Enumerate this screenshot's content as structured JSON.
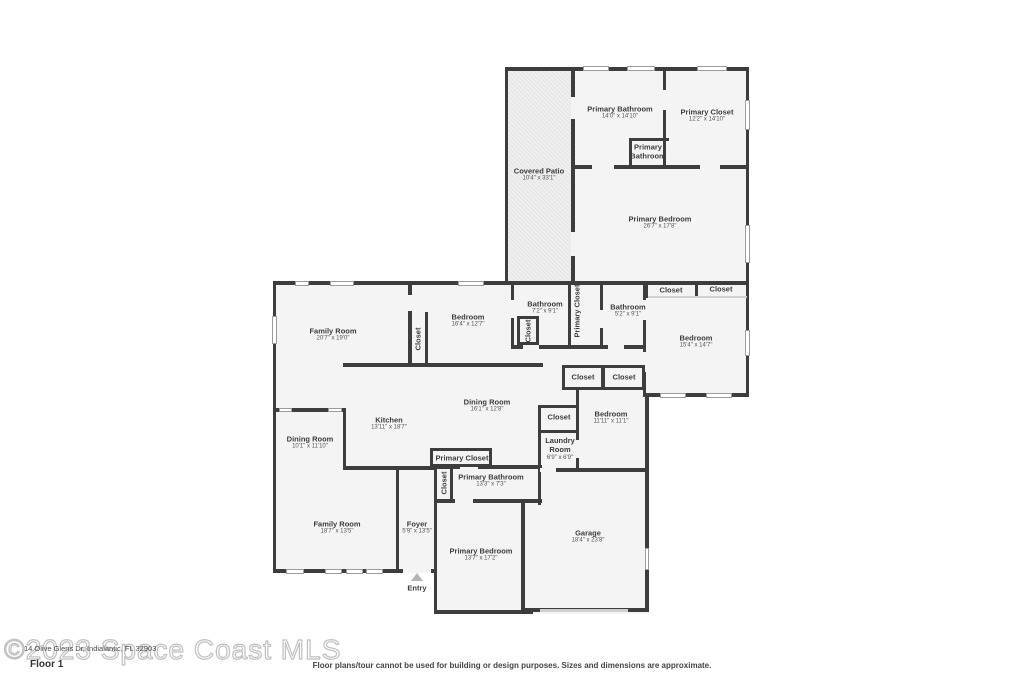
{
  "colors": {
    "wall": "#3d3d3d",
    "room_fill": "#f4f4f4",
    "page_bg": "#ffffff",
    "window": "#ffffff"
  },
  "watermark": {
    "outline": "©2023 Space Coast MLS",
    "address": "14 Olive Glens Dr, Indialantic, FL 32903"
  },
  "footer": {
    "floor": "Floor 1",
    "disclaimer": "Floor plans/tour cannot be used for building or design purposes. Sizes and dimensions are approximate."
  },
  "plan": {
    "rooms": [
      {
        "id": "primary-bathroom-upper",
        "label": "Primary Bathroom",
        "dims": "14'0\" x 14'10\""
      },
      {
        "id": "primary-closet-upper",
        "label": "Primary Closet",
        "dims": "12'2\" x 14'10\""
      },
      {
        "id": "primary-bathroom-small",
        "label": "Primary Bathroom",
        "dims": ""
      },
      {
        "id": "covered-patio",
        "label": "Covered Patio",
        "dims": "10'4\" x 33'1\""
      },
      {
        "id": "primary-bedroom-upper",
        "label": "Primary Bedroom",
        "dims": "26'7\" x 17'8\""
      },
      {
        "id": "family-room-upper",
        "label": "Family Room",
        "dims": "20'7\" x 19'0\""
      },
      {
        "id": "bedroom-mid",
        "label": "Bedroom",
        "dims": "16'4\" x 12'7\""
      },
      {
        "id": "closet-bedroom-mid",
        "label": "Closet",
        "vertical": true
      },
      {
        "id": "bathroom-hall",
        "label": "Bathroom",
        "dims": "7'2\" x 9'1\""
      },
      {
        "id": "closet-bathroom-hall",
        "label": "Closet",
        "vertical": true
      },
      {
        "id": "primary-closet-hall",
        "label": "Primary Closet",
        "vertical": true
      },
      {
        "id": "bathroom-right",
        "label": "Bathroom",
        "dims": "5'2\" x 9'1\""
      },
      {
        "id": "closet-right-a",
        "label": "Closet"
      },
      {
        "id": "closet-right-b",
        "label": "Closet"
      },
      {
        "id": "bedroom-right",
        "label": "Bedroom",
        "dims": "15'4\" x 14'7\""
      },
      {
        "id": "closet-mid-a",
        "label": "Closet"
      },
      {
        "id": "closet-mid-b",
        "label": "Closet"
      },
      {
        "id": "dining-room-main",
        "label": "Dining Room",
        "dims": "16'1\" x 12'8\""
      },
      {
        "id": "kitchen",
        "label": "Kitchen",
        "dims": "13'11\" x 18'7\""
      },
      {
        "id": "dining-room-left",
        "label": "Dining Room",
        "dims": "10'1\" x 11'10\""
      },
      {
        "id": "closet-laundry",
        "label": "Closet"
      },
      {
        "id": "bedroom-center",
        "label": "Bedroom",
        "dims": "11'11\" x 11'1\""
      },
      {
        "id": "laundry-room",
        "label": "Laundry Room",
        "dims": "6'9\" x 6'9\""
      },
      {
        "id": "primary-closet-lower",
        "label": "Primary Closet"
      },
      {
        "id": "closet-foyer",
        "label": "Closet",
        "vertical": true
      },
      {
        "id": "primary-bathroom-lower",
        "label": "Primary Bathroom",
        "dims": "13'3\" x 7'3\""
      },
      {
        "id": "family-room-lower",
        "label": "Family Room",
        "dims": "18'7\" x 13'5\""
      },
      {
        "id": "foyer",
        "label": "Foyer",
        "dims": "5'9\" x 13'5\""
      },
      {
        "id": "primary-bedroom-lower",
        "label": "Primary Bedroom",
        "dims": "13'7\" x 17'2\""
      },
      {
        "id": "garage",
        "label": "Garage",
        "dims": "18'4\" x 23'8\""
      },
      {
        "id": "entry",
        "label": "Entry"
      }
    ]
  }
}
